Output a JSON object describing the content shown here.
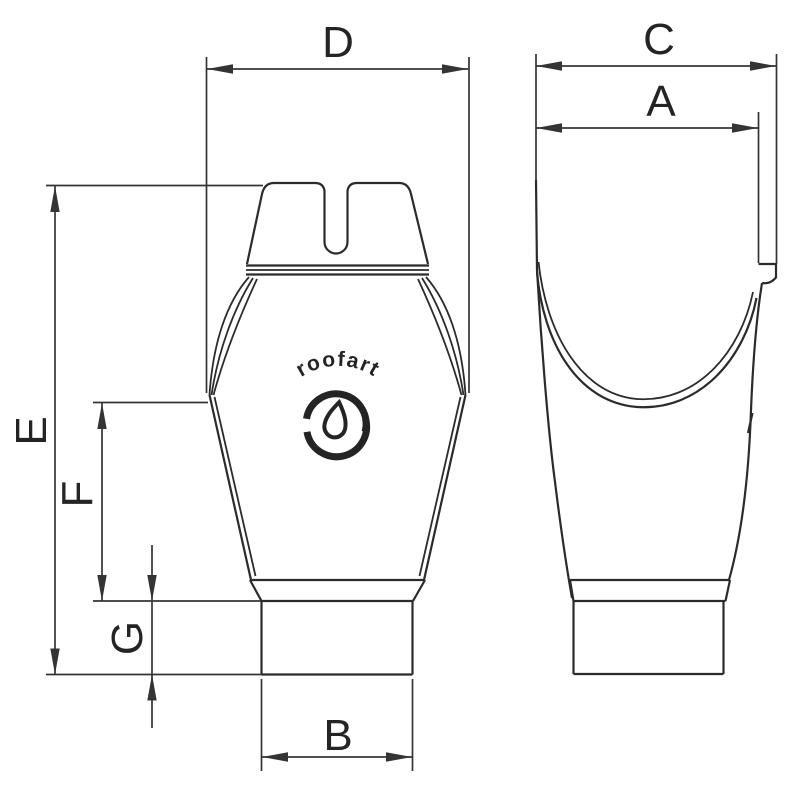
{
  "colors": {
    "background": "#ffffff",
    "line": "#2b2b2b",
    "dimension": "#343434"
  },
  "labels": {
    "A": "A",
    "B": "B",
    "C": "C",
    "D": "D",
    "E": "E",
    "F": "F",
    "G": "G"
  },
  "logo": {
    "brand": "roofart",
    "emblem": "water-drop-swirl-icon"
  }
}
